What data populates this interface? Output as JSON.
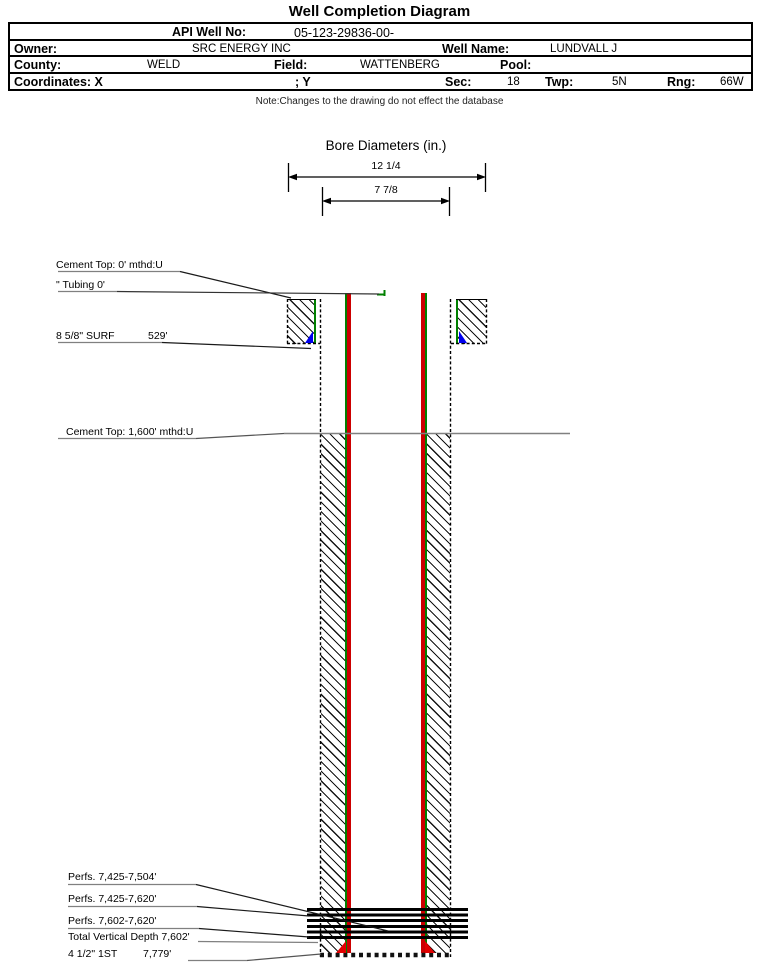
{
  "title": "Well Completion Diagram",
  "header": {
    "api_label": "API Well No:",
    "api_value": "05-123-29836-00-",
    "owner_label": "Owner:",
    "owner_value": "SRC ENERGY INC",
    "well_name_label": "Well Name:",
    "well_name_value": "LUNDVALL J",
    "county_label": "County:",
    "county_value": "WELD",
    "field_label": "Field:",
    "field_value": "WATTENBERG",
    "pool_label": "Pool:",
    "pool_value": "",
    "coordinates_label": "Coordinates: X",
    "coordinates_y_label": "; Y",
    "sec_label": "Sec:",
    "sec_value": "18",
    "twp_label": "Twp:",
    "twp_value": "5N",
    "rng_label": "Rng:",
    "rng_value": "66W",
    "note": "Note:Changes to the drawing do not effect the database"
  },
  "bore": {
    "title": "Bore Diameters (in.)",
    "outer_diameter": "12 1/4",
    "inner_diameter": "7 7/8"
  },
  "annotations": {
    "cement_top_surface": "Cement Top: 0' mthd:U",
    "tubing": "\" Tubing 0'",
    "surface_casing": "8 5/8\" SURF",
    "surface_casing_depth": "529'",
    "cement_top_production": "Cement Top: 1,600' mthd:U",
    "perf_interval_1": "Perfs. 7,425-7,504'",
    "perf_interval_2": "Perfs. 7,425-7,620'",
    "perf_interval_3": "Perfs. 7,602-7,620'",
    "total_vertical_depth": "Total Vertical Depth 7,602'",
    "production_casing": "4 1/2\" 1ST",
    "production_casing_depth": "7,779'"
  },
  "colors": {
    "casing_red": "#cc0000",
    "cement_bond_green": "#008000",
    "shoe_marker_blue": "#0000ee",
    "shoe_marker_red": "#e00000",
    "leader_gray": "#808080"
  }
}
